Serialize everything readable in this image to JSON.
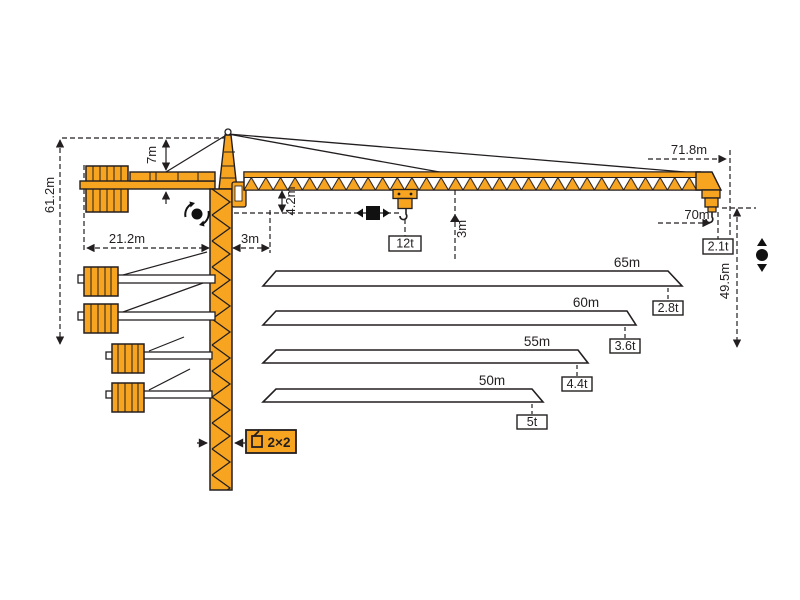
{
  "meta": {
    "title": "Tower crane working range and load diagram",
    "colors": {
      "crane_orange": "#F7A421",
      "outline": "#231F20",
      "label_box_bg": "#ffffff"
    }
  },
  "dimensions": {
    "total_height": "61.2m",
    "apex_to_jib": "7m",
    "counterjib_radius": "21.2m",
    "min_radius": "3m",
    "jib_underside_to_hook": "4.2m",
    "hook_to_jib_clearance": "3m",
    "jib_length": "71.8m",
    "max_hook_radius": "70m",
    "hook_height": "49.5m"
  },
  "loads": {
    "max_load": "12t",
    "tip_load": "2.1t"
  },
  "mast": {
    "section_label": "2×2"
  },
  "icons": {
    "slewing": "rotation-symbol",
    "trolley_travel": "horizontal-travel-symbol",
    "hoisting": "vertical-hoist-symbol"
  },
  "chart_data": {
    "type": "table",
    "title": "Jib length vs tip load",
    "columns": [
      "jib_length",
      "tip_load"
    ],
    "max_configuration": {
      "jib_length": "71.8m",
      "hook_radius": "70m",
      "tip_load": "2.1t",
      "max_load": "12t"
    },
    "options": [
      {
        "length": "65m",
        "tip_load": "2.8t"
      },
      {
        "length": "60m",
        "tip_load": "3.6t"
      },
      {
        "length": "55m",
        "tip_load": "4.4t"
      },
      {
        "length": "50m",
        "tip_load": "5t"
      }
    ]
  }
}
